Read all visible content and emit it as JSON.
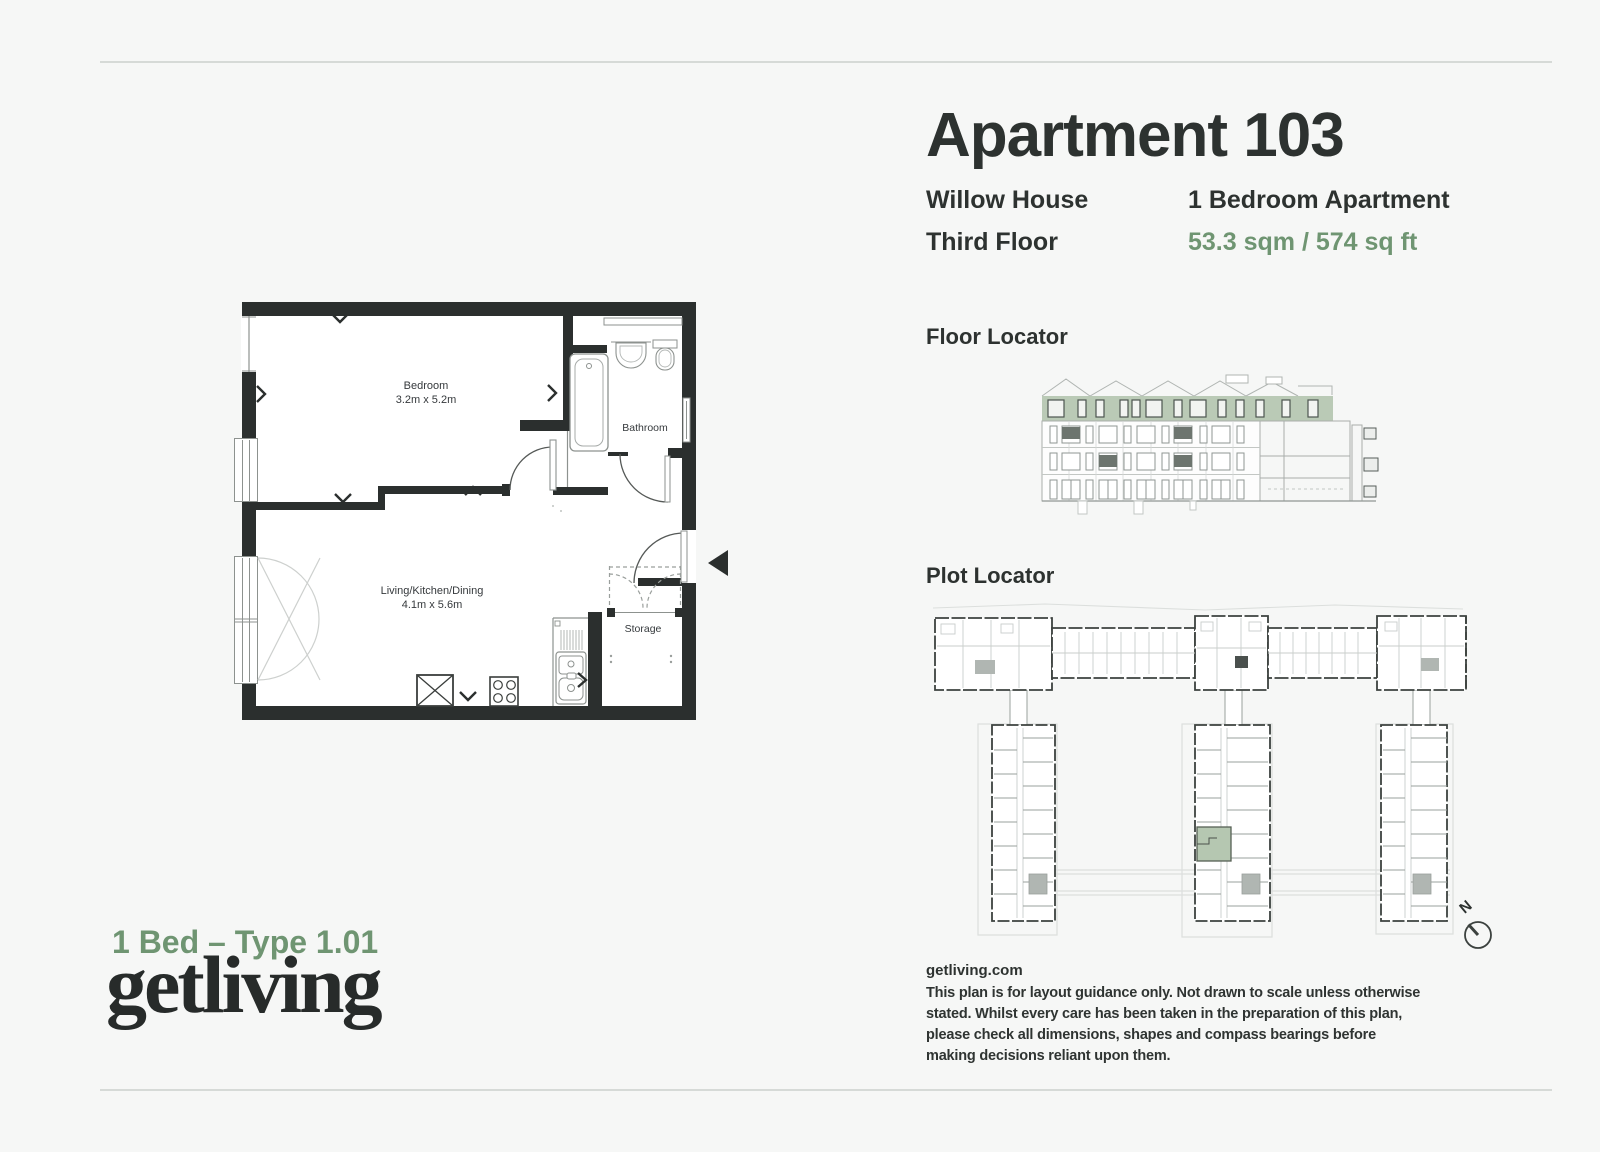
{
  "header": {
    "title": "Apartment 103",
    "building": "Willow House",
    "floor": "Third Floor",
    "apartment_type": "1 Bedroom Apartment",
    "area": "53.3 sqm / 574 sq ft"
  },
  "sections": {
    "floor_locator": "Floor Locator",
    "plot_locator": "Plot Locator"
  },
  "floorplan": {
    "bedroom_name": "Bedroom",
    "bedroom_dims": "3.2m x 5.2m",
    "living_name": "Living/Kitchen/Dining",
    "living_dims": "4.1m x 5.6m",
    "bathroom_name": "Bathroom",
    "storage_name": "Storage"
  },
  "compass": {
    "north_label": "N"
  },
  "footer": {
    "type_label": "1 Bed – Type 1.01",
    "logo": "getliving",
    "website": "getliving.com",
    "disclaimer_lines": [
      "This plan is for layout guidance only. Not drawn to scale unless otherwise",
      "stated. Whilst every care has been taken in the preparation of this plan,",
      "please check all dimensions, shapes and compass bearings before",
      "making decisions reliant upon them."
    ]
  },
  "colors": {
    "background": "#f6f7f6",
    "ink": "#2d3230",
    "accent_green": "#6f9572",
    "highlight_green": "#b5c7b1",
    "wall_black": "#2b2f2e",
    "rule_gray": "#d6dad7"
  }
}
